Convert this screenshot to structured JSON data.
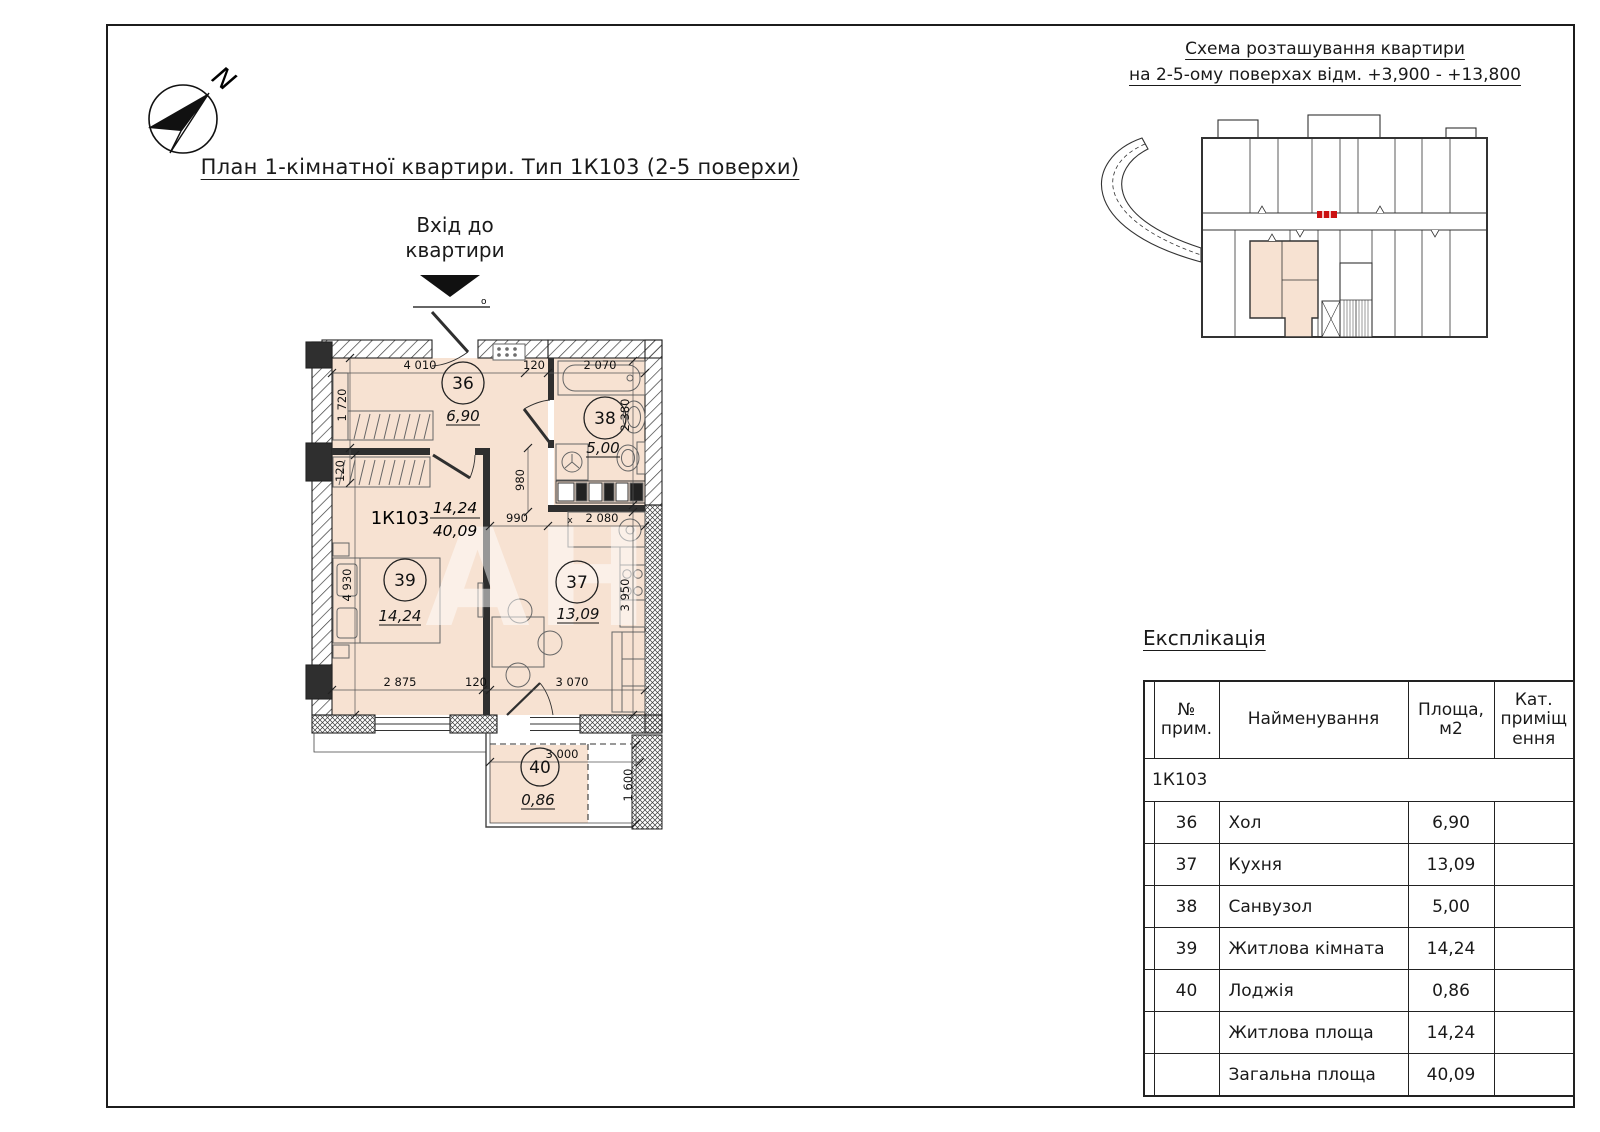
{
  "sheet": {
    "compass_n": "N",
    "title": "План 1-кімнатної квартири. Тип 1К103 (2-5 поверхи)",
    "entrance_line1": "Вхід до",
    "entrance_line2": "квартири",
    "door_mark": "о",
    "watermark": "АН"
  },
  "scheme": {
    "title_line1": "Схема розташування квартири",
    "title_line2": "на 2-5-ому поверхах відм. +3,900 - +13,800"
  },
  "plan": {
    "apartment_code": "1К103",
    "living_area": "14,24",
    "total_area": "40,09",
    "rooms": {
      "r36": {
        "num": "36",
        "area": "6,90"
      },
      "r37": {
        "num": "37",
        "area": "13,09"
      },
      "r38": {
        "num": "38",
        "area": "5,00"
      },
      "r39": {
        "num": "39",
        "area": "14,24"
      },
      "r40": {
        "num": "40",
        "area": "0,86"
      }
    },
    "dims": {
      "hall_w": "4 010",
      "hall_wall": "120",
      "bath_w": "2 070",
      "hall_h": "1 720",
      "wall_b": "120",
      "living_h": "4 930",
      "corridor_h": "980",
      "corridor_w": "990",
      "x_mark": "х",
      "kitchen_w": "2 080",
      "bath_h": "2 380",
      "kitchen_h": "3 950",
      "living_w": "2 875",
      "wall_c": "120",
      "kitchen_bw": "3 070",
      "loggia_w": "3 000",
      "loggia_h": "1 600"
    }
  },
  "legend": {
    "title": "Експлікація",
    "headers": {
      "num": "№\nприм.",
      "name": "Найменування",
      "area": "Площа,\nм2",
      "cat": "Кат.\nприміщ\nення"
    },
    "group": "1К103",
    "rows": [
      {
        "num": "36",
        "name": "Хол",
        "area": "6,90",
        "cat": ""
      },
      {
        "num": "37",
        "name": "Кухня",
        "area": "13,09",
        "cat": ""
      },
      {
        "num": "38",
        "name": "Санвузол",
        "area": "5,00",
        "cat": ""
      },
      {
        "num": "39",
        "name": "Житлова кімната",
        "area": "14,24",
        "cat": ""
      },
      {
        "num": "40",
        "name": "Лоджія",
        "area": "0,86",
        "cat": ""
      },
      {
        "num": "",
        "name": "Житлова площа",
        "area": "14,24",
        "cat": ""
      },
      {
        "num": "",
        "name": "Загальна площа",
        "area": "40,09",
        "cat": ""
      }
    ]
  },
  "colors": {
    "room_fill": "#f7e2d2",
    "wall": "#2f2f2f",
    "marker_red": "#cc1111"
  }
}
